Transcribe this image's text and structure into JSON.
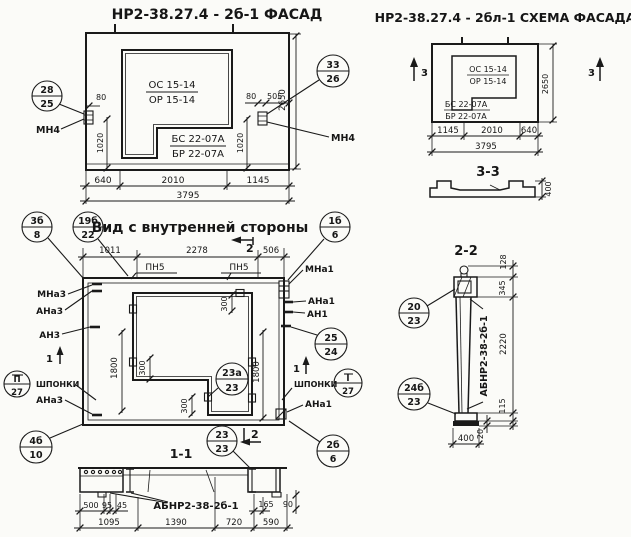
{
  "facade": {
    "title": "НР2-38.27.4 - 2б-1 ФАСАД",
    "window_mark": {
      "top": "ОС 15-14",
      "bottom": "ОР 15-14"
    },
    "block_mark": {
      "top": "БС 22-07А",
      "bottom": "БР 22-07А"
    },
    "balloon_left": {
      "top": "28",
      "bottom": "25"
    },
    "balloon_right": {
      "top": "33",
      "bottom": "26"
    },
    "anchor_left": "МН4",
    "anchor_right": "МН4",
    "dims": {
      "a80l": "80",
      "a80r": "80",
      "a505": "505",
      "v1020l": "1020",
      "v1020r": "1020",
      "v2650": "2650",
      "b640": "640",
      "b2010": "2010",
      "b1145": "1145",
      "b3795": "3795"
    }
  },
  "scheme": {
    "title": "НР2-38.27.4 - 2бл-1 СХЕМА ФАСАДА",
    "window_mark": {
      "top": "ОС 15-14",
      "bottom": "ОР 15-14"
    },
    "block_mark": {
      "top": "БС 22-07А",
      "bottom": "БР 22-07А"
    },
    "cut3": "3",
    "dims": {
      "v2650": "2650",
      "b1145": "1145",
      "b2010": "2010",
      "b640": "640",
      "b3795": "3795"
    }
  },
  "section33": {
    "title": "3-3",
    "d400": "400"
  },
  "inner": {
    "title": "Вид с внутренней стороны",
    "balloons": {
      "b3b8": {
        "top": "3б",
        "bottom": "8"
      },
      "b19b22": {
        "top": "19б",
        "bottom": "22"
      },
      "b1b6": {
        "top": "1б",
        "bottom": "6"
      },
      "b2b6": {
        "top": "2б",
        "bottom": "6"
      },
      "b4b10": {
        "top": "4б",
        "bottom": "10"
      },
      "b2524": {
        "top": "25",
        "bottom": "24"
      },
      "b23a23": {
        "top": "23а",
        "bottom": "23"
      },
      "keys_left": {
        "top": "П",
        "bottom": "27"
      },
      "keys_right": {
        "top": "I",
        "bottom": "27"
      }
    },
    "labels_left": {
      "mna3": "МНа3",
      "ana3": "АНа3",
      "an3": "АН3",
      "keys": "ШПОНКИ",
      "ana3b": "АНа3"
    },
    "labels_right": {
      "mna1": "МНа1",
      "ana1": "АНа1",
      "an1": "АН1",
      "keys": "ШПОНКИ",
      "ana1b": "АНа1"
    },
    "pn5": "ПН5",
    "cut1": "1",
    "cut2": "2",
    "dims": {
      "t1011": "1011",
      "t2278": "2278",
      "t506": "506",
      "s300": "300",
      "v1800l": "1800",
      "v1800r": "1800"
    }
  },
  "section11": {
    "title": "1-1",
    "balloon": {
      "top": "23",
      "bottom": "23"
    },
    "cut2": "2",
    "label": "АБНР2-38-2б-1",
    "dims": {
      "d500": "500",
      "d95": "95",
      "d45": "45",
      "d165": "165",
      "d90": "90",
      "d1095": "1095",
      "d1390": "1390",
      "d720": "720",
      "d590": "590"
    }
  },
  "section22": {
    "title": "2-2",
    "balloon_top": {
      "top": "20",
      "bottom": "23"
    },
    "balloon_bottom": {
      "top": "24б",
      "bottom": "23"
    },
    "label": "АБНР2-38-2б-1",
    "dims": {
      "d128": "128",
      "d345": "345",
      "d2220": "2220",
      "d115": "115",
      "d20": "20",
      "d400": "400"
    }
  }
}
